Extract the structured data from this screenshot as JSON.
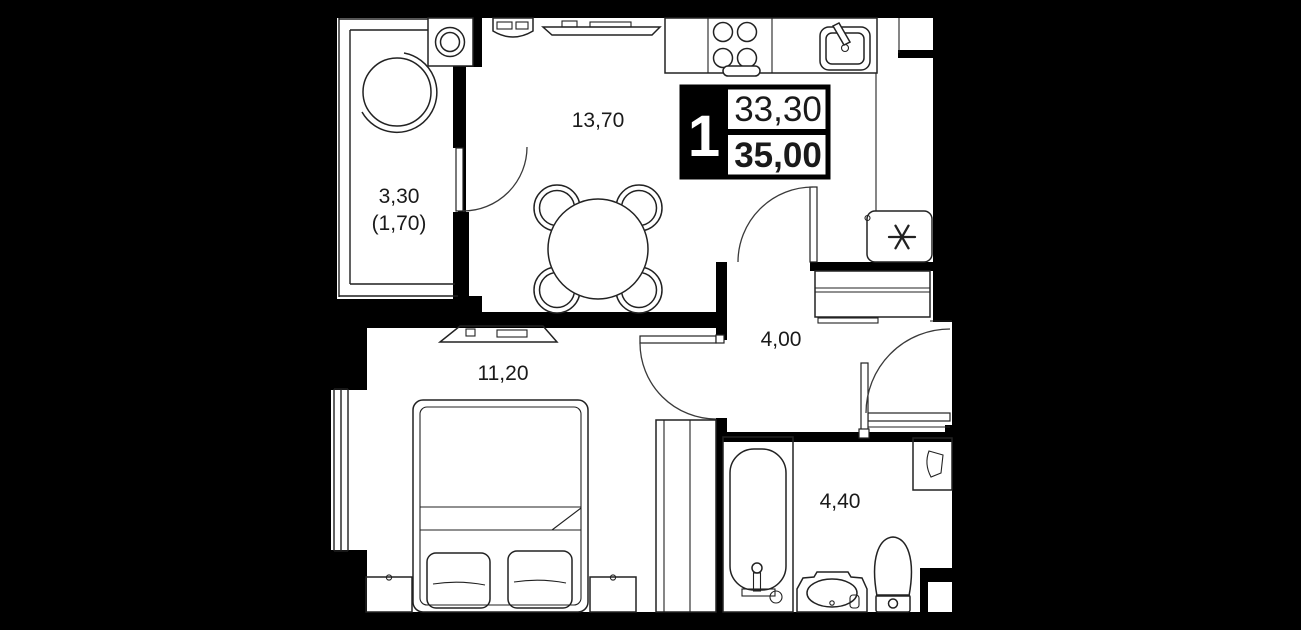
{
  "plan": {
    "badge": {
      "rooms_count": "1",
      "upper_area": "33,30",
      "lower_area": "35,00",
      "accent_color": "#000000",
      "text_color": "#ffffff"
    },
    "rooms": [
      {
        "name": "kitchen-living",
        "label": "13,70"
      },
      {
        "name": "balcony",
        "label": "3,30",
        "label_secondary": "(1,70)"
      },
      {
        "name": "bedroom",
        "label": "11,20"
      },
      {
        "name": "hallway",
        "label": "4,00"
      },
      {
        "name": "bathroom",
        "label": "4,40"
      }
    ],
    "icons": {
      "fridge": "snowflake-asterisk",
      "washing_machine": "drum-circles",
      "stove": "four-burners",
      "sink": "basin-with-faucet",
      "bathtub": "tub-with-faucet",
      "toilet": "toilet-top-view",
      "washbasin": "vanity-oval",
      "tv": "tv-top-view",
      "armchair": "round-chair",
      "dining_table": "round-table-4-chairs",
      "wardrobe": "double-wardrobe",
      "bed": "double-bed-2-pillows"
    },
    "colors": {
      "wall": "#000000",
      "floor": "#ffffff",
      "line": "#1f1f1f"
    }
  }
}
